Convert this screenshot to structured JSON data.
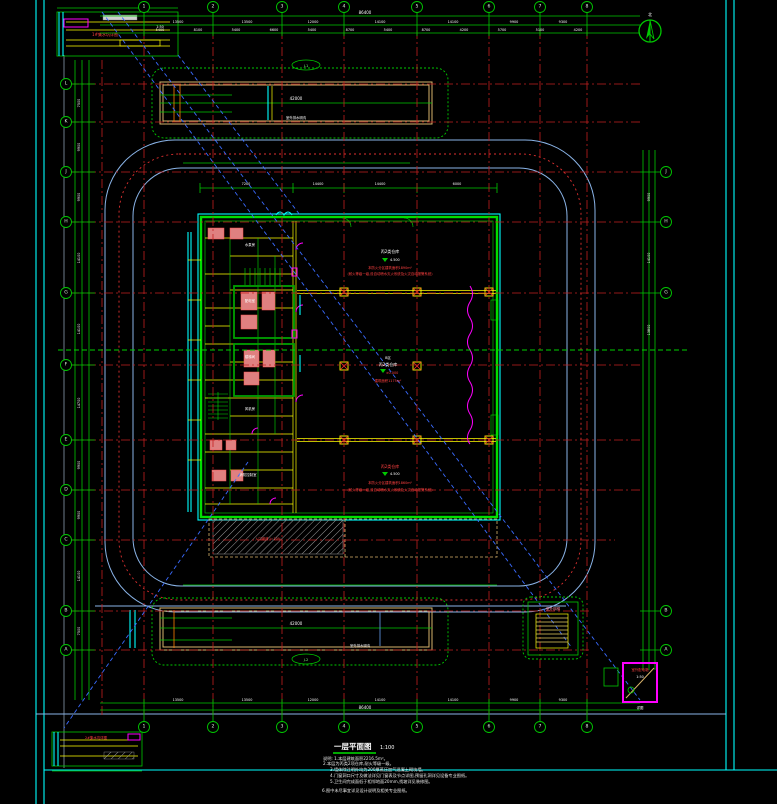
{
  "drawing": {
    "title": "一层平面图",
    "scale": "1:100",
    "north_label": "北"
  },
  "grid": {
    "cols": [
      "1",
      "2",
      "3",
      "4",
      "5",
      "6",
      "7",
      "8"
    ],
    "rows": [
      "L",
      "K",
      "J",
      "H",
      "G",
      "F",
      "E",
      "D",
      "C",
      "B",
      "A"
    ]
  },
  "dims": {
    "top_total": "86400",
    "top_bays": [
      "13500",
      "13500",
      "12000",
      "14100",
      "14100",
      "9900",
      "9300"
    ],
    "top_sub": [
      "5400",
      "8100",
      "5400",
      "6600",
      "5400",
      "8700",
      "5400",
      "8700",
      "4200",
      "5700",
      "5100",
      "4200"
    ],
    "bottom_bays": [
      "13500",
      "13500",
      "12000",
      "14100",
      "14100",
      "9900",
      "9300"
    ],
    "bottom_total": "86400",
    "left": [
      "7500",
      "9900",
      "9900",
      "14100",
      "14100",
      "14700",
      "9900",
      "9900",
      "14100",
      "7500"
    ],
    "right": [
      "9900",
      "14100",
      "13800"
    ],
    "bldg_top": [
      "7200",
      "14400",
      "14400",
      "6000"
    ]
  },
  "blocks": {
    "top": {
      "tag": "J-1",
      "label": "室外排水明沟",
      "dim": "42000"
    },
    "bottom": {
      "tag": "J-2",
      "label": "室外排水明沟",
      "dim": "42000"
    },
    "top_left": {
      "label": "1#集水坑详图",
      "note": "1:50"
    },
    "bottom_left": {
      "label": "2#集水坑详图"
    },
    "stair": {
      "label": "室外钢梯"
    },
    "switch_box": {
      "l1": "室外配电箱",
      "l2": "1:50",
      "l3": "详图"
    }
  },
  "rooms": {
    "upper": {
      "name": "丙2类仓库",
      "elev": "4.500",
      "note1": "本防火分区建筑面积1890m²",
      "note2": "(耐火等级一级,设自动喷水灭火系统及火灾自动报警系统)"
    },
    "middle": {
      "tag": "B区",
      "name": "丙2类仓库",
      "elev": "±0.000",
      "note1": "建筑面积1175m²"
    },
    "lower": {
      "name": "丙2类仓库",
      "elev": "4.500",
      "note1": "本防火分区建筑面积1860m²",
      "note2": "(耐火等级一级,设自动喷水灭火系统及火灾自动报警系统)"
    },
    "ramp": "入口坡道 i=10%",
    "left_rooms": [
      "水泵房",
      "配电室",
      "楼梯间",
      "风机房",
      "消防控制室"
    ]
  },
  "notes": {
    "n1": "说明: 1.本层建筑面积2216.5m²。",
    "n2": "2.本层为丙类2项仓库,耐火等级一级。",
    "n3": "3.墙体除注明外均为200厚蒸压加气混凝土砌块墙。",
    "n4": "4.门窗洞口尺寸及做法详见门窗表及节点详图,预留孔洞详见设备专业图纸。",
    "n5": "5.卫生间完成面低于相邻地面20mm,找坡详见装修图。",
    "n6": "6.图中未尽事宜详见设计说明及相关专业图纸。"
  },
  "colors": {
    "background": "#000000",
    "grid": "#c22020",
    "dimension": "#00c800",
    "road": "#8ab4e8",
    "fire_lane": "#e03030",
    "wall": "#00e000",
    "beam": "#ffff00",
    "joint": "#ff00ff",
    "trench": "#d9b36b",
    "water": "#00ffff",
    "leader": "#3a6bff"
  }
}
